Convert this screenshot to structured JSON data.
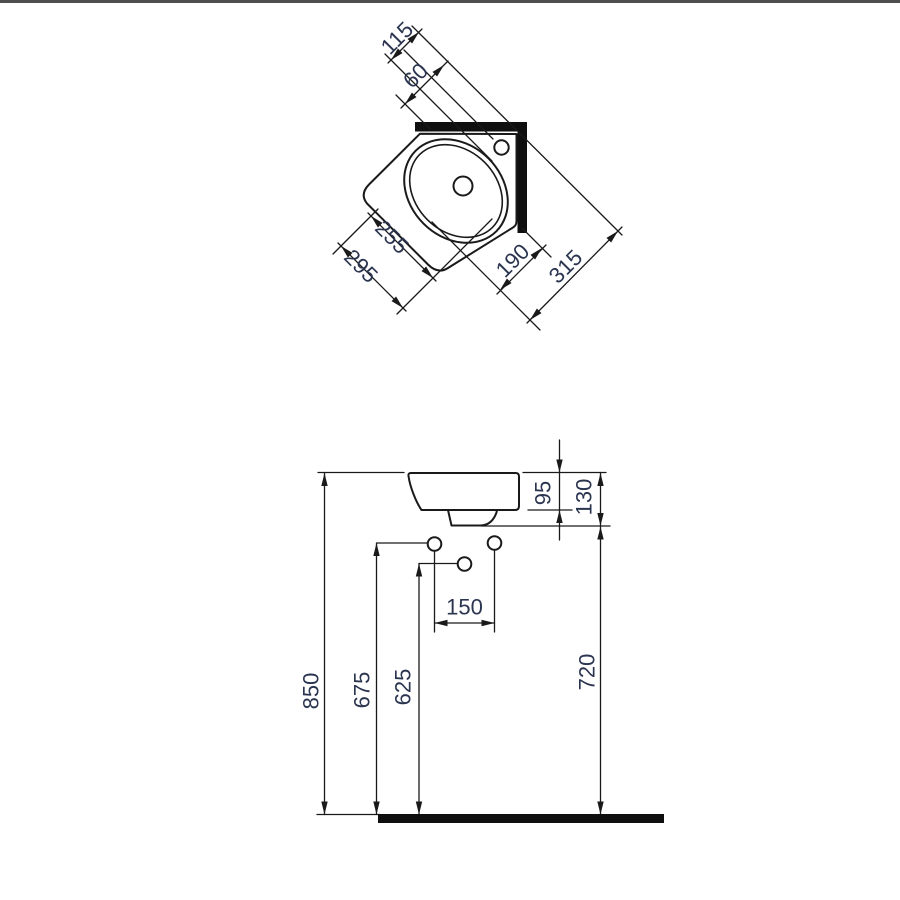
{
  "colors": {
    "background": "#ffffff",
    "top_border": "#4f4f4f",
    "line": "#1a1a1a",
    "solid_fill": "#0f0f0f",
    "dim_text": "#2b3550"
  },
  "top_view": {
    "dims": {
      "d115": "115",
      "d60": "60",
      "d255": "255",
      "d295": "295",
      "d190": "190",
      "d315": "315"
    }
  },
  "front_view": {
    "dims": {
      "d95": "95",
      "d130": "130",
      "d150": "150",
      "d850": "850",
      "d675": "675",
      "d625": "625",
      "d720": "720"
    }
  }
}
